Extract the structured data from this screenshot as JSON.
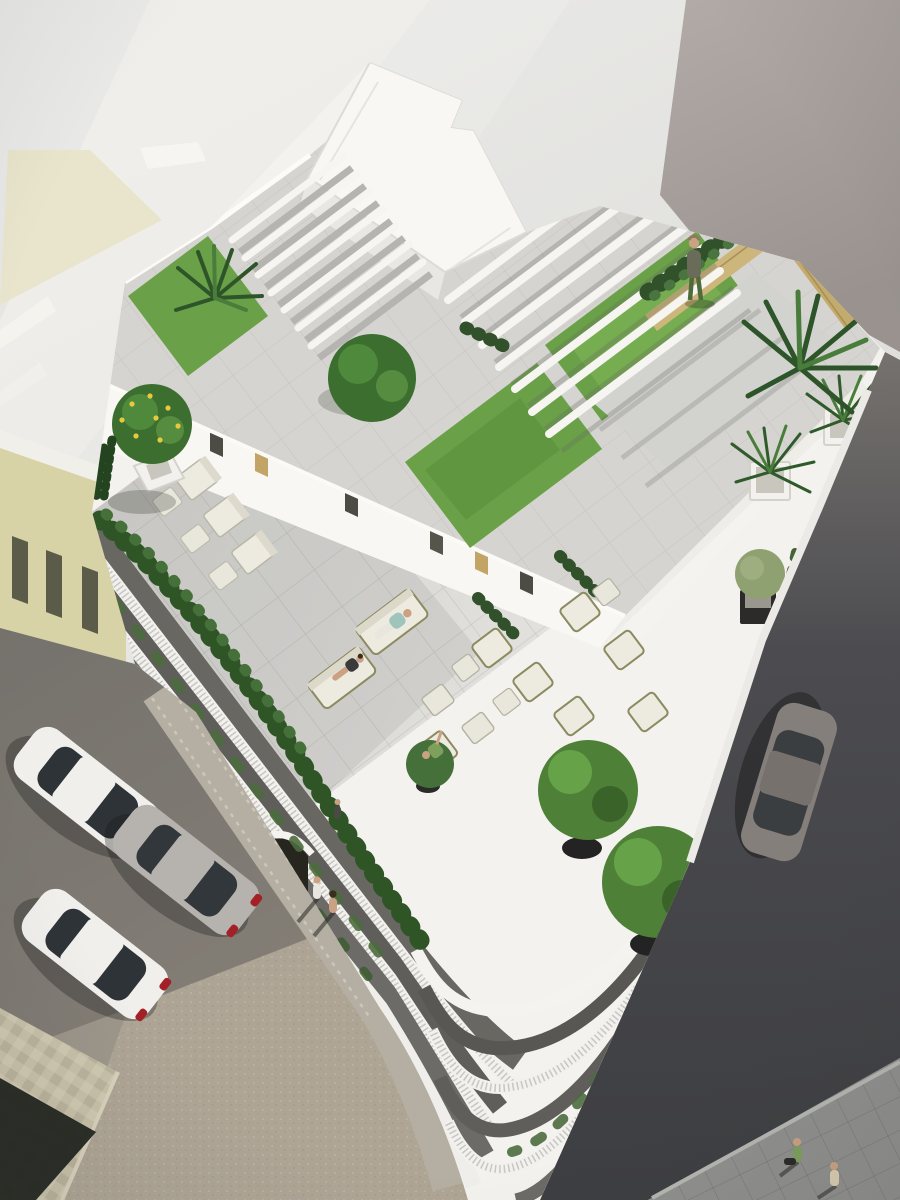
{
  "scene": {
    "type": "architectural-rendering",
    "view": "aerial-oblique",
    "subject": "white residential building with landscaped roof terraces, pergolas, lawns and street below",
    "time_of_day": "sunny daylight, long shadows toward lower-left"
  },
  "colors": {
    "sky_top": "#ebebe9",
    "sky_bottom": "#d8d7d4",
    "streak_cream": "#e9e5cc",
    "neighbor_gray_light": "#b2abA7",
    "neighbor_gray_dark": "#99928e",
    "neighbor_yellow": "#d8d3a6",
    "building_white": "#f3f2ee",
    "wall_bright": "#f8f7f3",
    "wall_side": "#efede7",
    "slab_white": "#f8f7f4",
    "floor_paver": "#d8d7d3",
    "roof_paver": "#d5d4d0",
    "courtyard_paver": "#d2d2cf",
    "lawn": "#6aa148",
    "lawn_dark": "#4b7c33",
    "tree": "#3c6e2f",
    "tree_light": "#5d9444",
    "hedge": "#31512a",
    "hedge_light": "#4a7440",
    "palm_dark": "#2e5429",
    "palm_light": "#4a7c3c",
    "olive_tree": "#8fa071",
    "wood": "#cdb67c",
    "cushion": "#edebe0",
    "frame_olive": "#8b8a60",
    "planter_black": "#2c2b29",
    "planter_white": "#f2f1ed",
    "pebbles": "#c9c6bd",
    "asphalt_dark": "#434347",
    "asphalt_light": "#76726e",
    "street_warm": "#a39b8e",
    "street_shadow": "#6e6a64",
    "sidewalk_beige": "#c8c1a9",
    "sidewalk_gray": "#8f8f8d",
    "shadow_dark": "#20231e",
    "recess_dark": "#686762",
    "car_white": "#f1efec",
    "car_silver": "#b6b3af",
    "car_graphite": "#857f7c",
    "glass": "#2e3337",
    "taillight": "#a32126",
    "skin": "#caa183",
    "shirt_teal": "#9fc4bc",
    "shirt_green": "#7da05c",
    "pants_white": "#e8e6df",
    "outfit_dark": "#3a3a3a",
    "shirt_olive": "#6b6b5a",
    "pants_green": "#4e6b3a",
    "curtain_gold": "#c2a566",
    "window_dark": "#4c4c45"
  },
  "objects": {
    "buildings": [
      {
        "label": "main-white-building",
        "floors_visible": 4,
        "features": [
          "roof pergolas",
          "roof lawns",
          "lounge terrace",
          "curved street corner",
          "picket balcony railings",
          "entrance arch"
        ]
      },
      {
        "label": "neighbor-gray-tower",
        "position": "top-right"
      },
      {
        "label": "neighbor-yellow-building",
        "position": "left",
        "windows": 3
      }
    ],
    "vehicles": [
      {
        "label": "parked-car-1",
        "color": "white",
        "street": "left"
      },
      {
        "label": "parked-car-2",
        "color": "silver",
        "street": "left"
      },
      {
        "label": "parked-car-3",
        "color": "white",
        "street": "left"
      },
      {
        "label": "parked-car-4",
        "color": "graphite",
        "street": "right"
      }
    ],
    "people": [
      {
        "label": "rooftop-resident",
        "where": "roof courtyard near wooden bench"
      },
      {
        "label": "lounge-man-teal",
        "where": "terrace sofa"
      },
      {
        "label": "lounge-woman",
        "where": "terrace sofa"
      },
      {
        "label": "lounge-man-green",
        "where": "terrace armchair"
      },
      {
        "label": "sidewalk-pedestrian-1",
        "where": "left sidewalk"
      },
      {
        "label": "sidewalk-pedestrian-2",
        "where": "left sidewalk"
      },
      {
        "label": "entrance-figure",
        "where": "near arch"
      },
      {
        "label": "crosswalk-person-green",
        "where": "bottom-right sidewalk"
      },
      {
        "label": "crosswalk-person-beige",
        "where": "bottom-right sidewalk"
      }
    ],
    "vegetation": {
      "lawns": 3,
      "roof_trees": 1,
      "palms": 4,
      "lemon_tree": 1,
      "potted_trees": 3,
      "olive_planters": 2,
      "palm_planters": 2,
      "hedges": [
        "courtyard hedge",
        "terrace edge hedge",
        "balcony trailing plants",
        "street vine"
      ]
    },
    "furniture": {
      "chaise_lounges": 3,
      "sofas": 2,
      "armchairs": 6,
      "ottomans": 6,
      "wooden_bench": 1,
      "pergola_slats": 7,
      "pergola_beams": 7
    }
  }
}
